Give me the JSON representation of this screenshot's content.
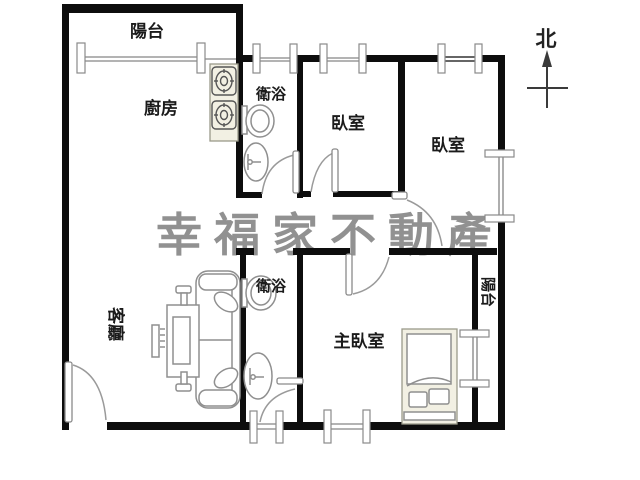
{
  "title": "apartment-floor-plan",
  "compass": {
    "label": "北"
  },
  "watermark": {
    "text": "幸福家不動產",
    "color": "#919191"
  },
  "rooms": {
    "balcony_top": "陽台",
    "kitchen": "廚房",
    "bathroom_top": "衛浴",
    "bedroom_1": "臥室",
    "bedroom_2": "臥室",
    "living_room": "客廳",
    "bathroom_bottom": "衛浴",
    "master_bedroom": "主臥室",
    "balcony_right": "陽台"
  },
  "fixtures": [
    "stove-icon",
    "toilet-icon",
    "sink-icon",
    "sofa-icon",
    "coffee-table-icon",
    "tv-icon",
    "bed-icon",
    "door-arc-icon",
    "window-icon",
    "north-arrow-icon"
  ],
  "colors": {
    "wall": "#0d0d0d",
    "fixture_line": "#8f8f8f",
    "furniture_fill": "#f2f0e3",
    "watermark": "#919191",
    "text": "#1b1b1b",
    "window_line": "#9a9a9a"
  }
}
